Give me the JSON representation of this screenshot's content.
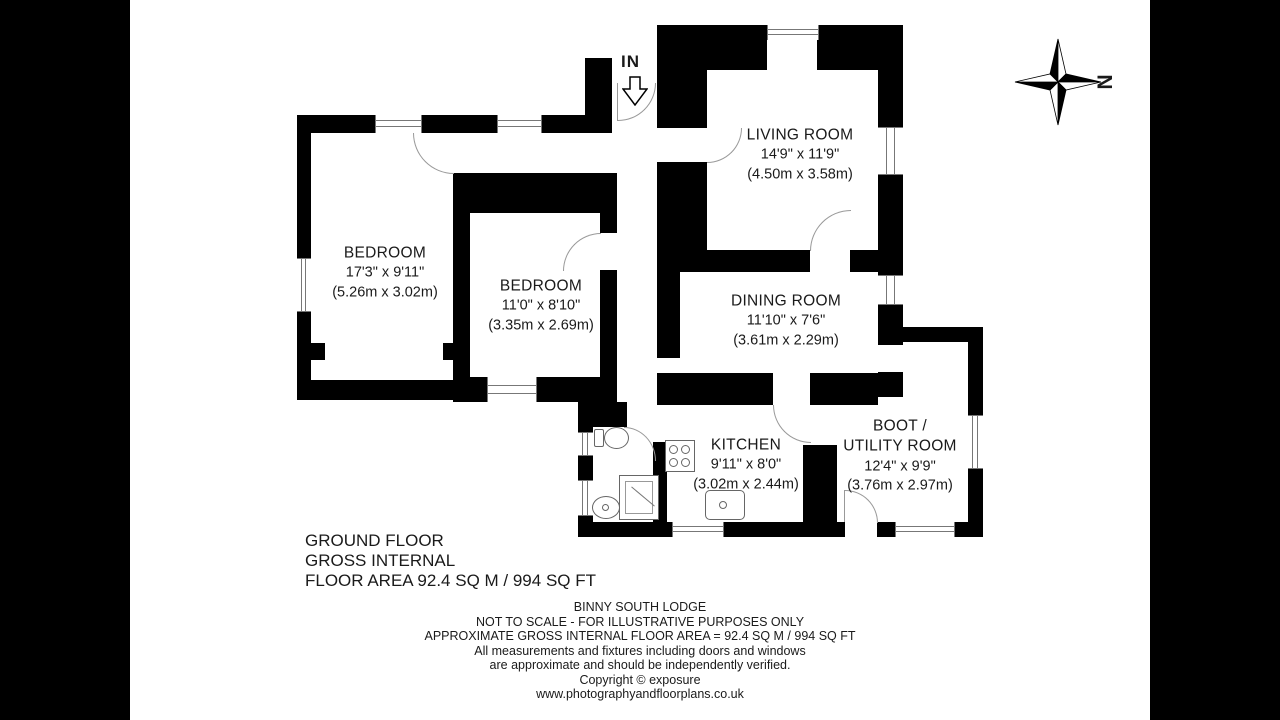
{
  "meta": {
    "background_color": "#ffffff",
    "wall_color": "#000000",
    "letterbox_color": "#000000"
  },
  "compass": {
    "north_label": "N"
  },
  "entrance": {
    "label": "IN"
  },
  "rooms": [
    {
      "id": "bedroom-1",
      "name": "BEDROOM",
      "dims_imperial": "17'3\" x 9'11\"",
      "dims_metric": "(5.26m x 3.02m)"
    },
    {
      "id": "bedroom-2",
      "name": "BEDROOM",
      "dims_imperial": "11'0\" x 8'10\"",
      "dims_metric": "(3.35m x 2.69m)"
    },
    {
      "id": "living-room",
      "name": "LIVING ROOM",
      "dims_imperial": "14'9\" x 11'9\"",
      "dims_metric": "(4.50m x 3.58m)"
    },
    {
      "id": "dining-room",
      "name": "DINING ROOM",
      "dims_imperial": "11'10\" x 7'6\"",
      "dims_metric": "(3.61m x 2.29m)"
    },
    {
      "id": "kitchen",
      "name": "KITCHEN",
      "dims_imperial": "9'11\" x 8'0\"",
      "dims_metric": "(3.02m x 2.44m)"
    },
    {
      "id": "boot-utility",
      "name_line1": "BOOT /",
      "name_line2": "UTILITY ROOM",
      "dims_imperial": "12'4\" x 9'9\"",
      "dims_metric": "(3.76m x 2.97m)"
    }
  ],
  "floor_summary": {
    "lines": [
      "GROUND FLOOR",
      "GROSS INTERNAL",
      "FLOOR AREA 92.4 SQ M / 994 SQ FT"
    ]
  },
  "disclaimer": {
    "lines": [
      "BINNY SOUTH LODGE",
      "NOT TO SCALE - FOR ILLUSTRATIVE PURPOSES ONLY",
      "APPROXIMATE GROSS INTERNAL FLOOR AREA = 92.4 SQ M / 994 SQ FT",
      "All measurements and fixtures including doors and windows",
      "are approximate and should be independently verified.",
      "Copyright ©  exposure",
      "www.photographyandfloorplans.co.uk"
    ]
  }
}
